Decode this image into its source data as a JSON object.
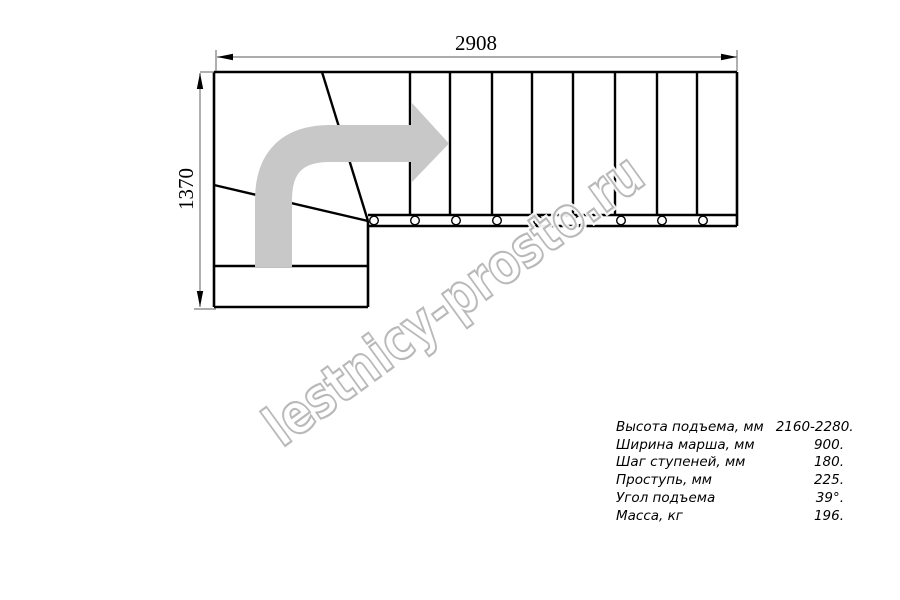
{
  "drawing": {
    "dimension_width_mm": "2908",
    "dimension_height_mm": "1370",
    "watermark_text": "lestnicy-prosto.ru"
  },
  "specs": {
    "rows": [
      {
        "label": "Высота подъема, мм",
        "value": "2160-2280."
      },
      {
        "label": "Ширина марша, мм",
        "value": "900."
      },
      {
        "label": "Шаг ступеней, мм",
        "value": "180."
      },
      {
        "label": "Проступь, мм",
        "value": "225."
      },
      {
        "label": "Угол подъема",
        "value": "39°."
      },
      {
        "label": "Масса, кг",
        "value": "196."
      }
    ]
  },
  "colors": {
    "background": "#ffffff",
    "outline": "#000000",
    "dimension_line": "#7a7a7a",
    "flow_arrow": "#c8c8c8",
    "watermark_stroke": "#b9b9b9"
  }
}
